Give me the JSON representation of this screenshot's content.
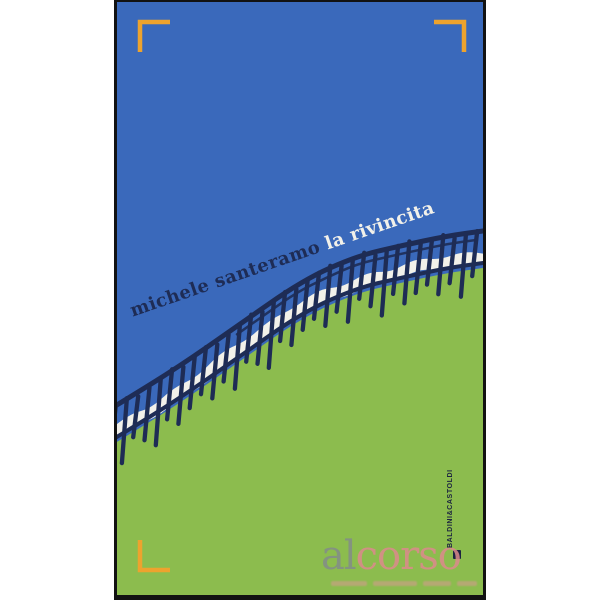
{
  "cover": {
    "author": "michele santeramo",
    "title": "la rivincita",
    "publisher": "BALDINI&CASTOLDI"
  },
  "watermark": {
    "part1": "al",
    "part2": "corso"
  },
  "colors": {
    "sky_blue": "#3a69bb",
    "grass_green": "#8cbc4e",
    "fence_navy": "#1e2c55",
    "title_white": "#f2f1ea",
    "bracket_orange": "#eda32e",
    "border_black": "#121212",
    "publisher_dark": "#1c2340",
    "watermark_gray": "#82888f",
    "watermark_pink": "#dd8a8d"
  }
}
